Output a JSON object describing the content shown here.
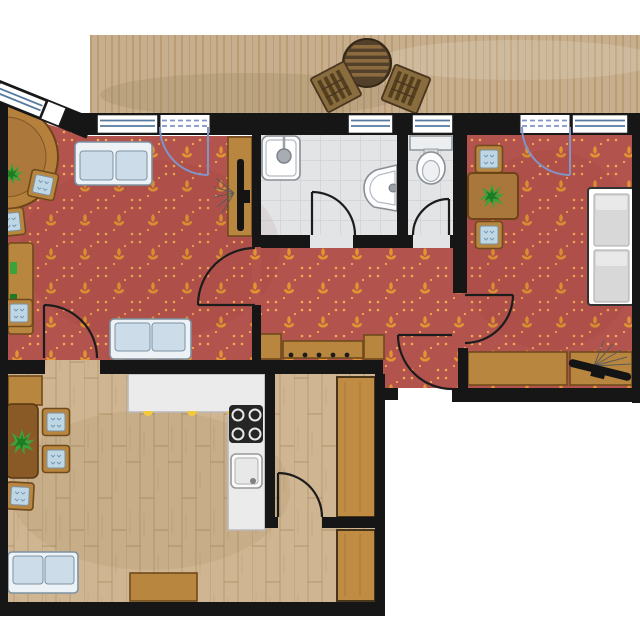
{
  "meta": {
    "title": "apartment-floor-plan",
    "canvas_width": 640,
    "canvas_height": 640
  },
  "colors": {
    "wall": "#161616",
    "carpetBase": "#b2534d",
    "carpetMotif": "#e3992f",
    "carpetDot": "#eeab52",
    "deckBase": "#c6ae8e",
    "deckLine": "#a9884f",
    "woodFloor": "#cfb591",
    "woodLine": "#a2875e",
    "tileBase": "#e2e4e6",
    "tileLine": "#c6c9cd",
    "furnitureWood": "#b8863f",
    "furnitureWoodDark": "#6e4a1c",
    "tableWood": "#8a5a26",
    "sofaFrame": "#edf2f6",
    "sofaEdge": "#7d91a2",
    "sofaCushion": "#ccdde9",
    "chairCushion": "#bfd7e4",
    "fixtureWhite": "#fbfcfd",
    "fixtureLine": "#8a8f94",
    "counter": "#ebebeb",
    "counterLine": "#b9b9b9",
    "stove": "#262626",
    "handleYellow": "#f2ca3e",
    "plantGreen": "#3ba33a",
    "plantGreenDark": "#1f7a24",
    "tvBlack": "#141414",
    "doorArc": "#1c1c1c",
    "glassDoorBlue": "#8094c8",
    "windowBlue": "#55799f",
    "exterior": "#ffffff",
    "wardrobe": "#c08b43",
    "deckTable": "#52402a"
  },
  "rooms": [
    {
      "name": "terrace",
      "floor": "wood-deck",
      "furniture": [
        "round-table",
        "chair",
        "chair"
      ]
    },
    {
      "name": "living-room",
      "floor": "red-carpet",
      "furniture": [
        "sofa",
        "sofa",
        "round-table",
        "plant",
        "stool",
        "stool",
        "desk",
        "desk-chair",
        "tv-cabinet",
        "tv",
        "lamp"
      ]
    },
    {
      "name": "hallway",
      "floor": "red-carpet",
      "furniture": [
        "shoe-cabinet",
        "coat-bench-with-hooks",
        "cabinet"
      ]
    },
    {
      "name": "shower-room",
      "floor": "gray-tiles",
      "furniture": [
        "shower",
        "washbasin"
      ]
    },
    {
      "name": "wc",
      "floor": "gray-tiles",
      "furniture": [
        "toilet"
      ]
    },
    {
      "name": "bedroom",
      "floor": "red-carpet",
      "furniture": [
        "chair",
        "chair",
        "table",
        "plant",
        "double-bed",
        "sideboard",
        "sideboard",
        "tv",
        "lamp"
      ]
    },
    {
      "name": "kitchen",
      "floor": "wood-planks",
      "furniture": [
        "sideboard",
        "dining-table",
        "plant",
        "chair",
        "chair",
        "chair",
        "l-shaped-counter",
        "stove",
        "sink",
        "sofa",
        "sideboard",
        "wardrobe"
      ]
    },
    {
      "name": "storage-room",
      "floor": "wood-planks",
      "furniture": [
        "wardrobe"
      ]
    }
  ],
  "openings": {
    "windows": [
      "bay-window",
      "living-room-window",
      "shower-room-window",
      "wc-window",
      "bedroom-window"
    ],
    "glass_terrace_doors": [
      "living-room-terrace-door",
      "bedroom-terrace-door"
    ],
    "interior_doors": [
      "living-kitchen-door",
      "living-hallway-door",
      "shower-door",
      "wc-door",
      "bedroom-door",
      "storage-door"
    ],
    "entrance_doors": [
      "apartment-entrance-door"
    ]
  }
}
